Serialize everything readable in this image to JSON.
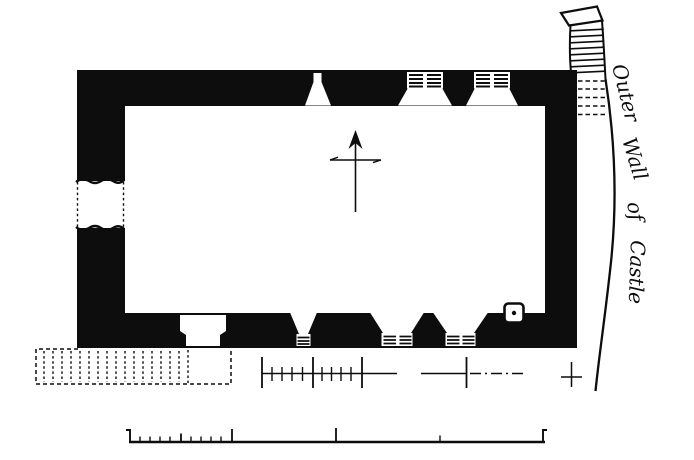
{
  "drawing": {
    "kind": "architectural-plan-engraving",
    "labels": {
      "outer_wall": [
        "Outer",
        "Wall",
        "of",
        "Castle"
      ]
    },
    "colors": {
      "ink": "#0d0d0d",
      "paper": "#ffffff"
    },
    "features": {
      "north_arrow": "north-arrow",
      "scale_bar": "divided-scale-bar",
      "survey_line": "survey-dimension-line",
      "wall_breach": "ruined-wall-gap",
      "doorway": "south-doorway",
      "recess": "small-wall-recess",
      "annex": "dashed-ruined-annex",
      "castle_wall": "curved-outer-castle-wall"
    }
  }
}
